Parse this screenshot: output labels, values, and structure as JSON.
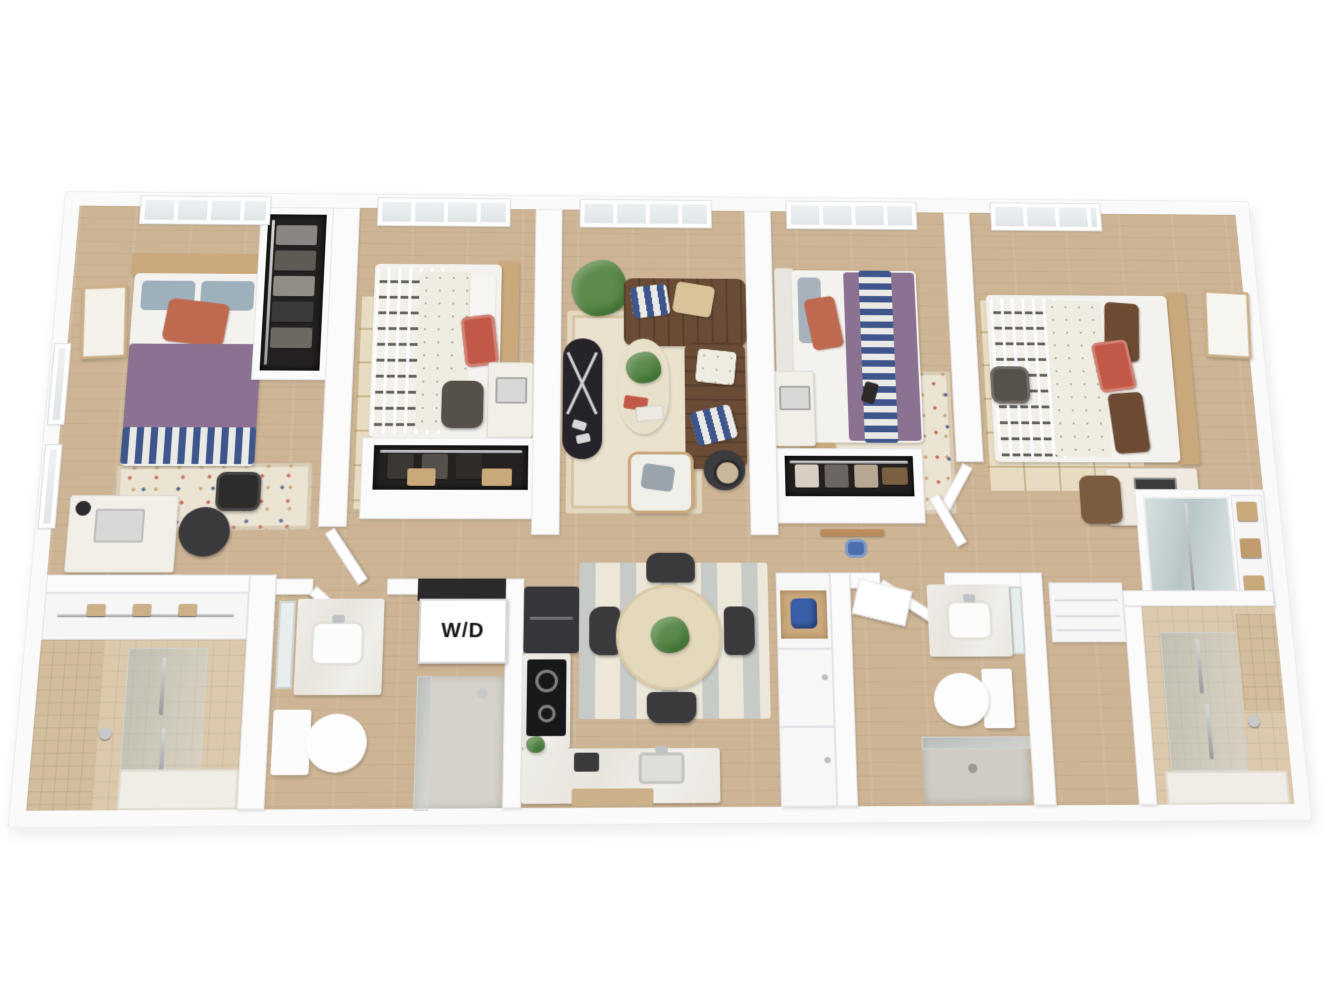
{
  "floorplan": {
    "type": "3d-apartment-floor-plan",
    "visible_text": {
      "washer_dryer": "W/D"
    },
    "rooms": [
      "bedroom-1",
      "bedroom-2",
      "living-room",
      "bedroom-3",
      "bedroom-4",
      "bathroom-1",
      "bathroom-2",
      "bathroom-3",
      "kitchen",
      "dining-area",
      "hallway",
      "walk-in-closets",
      "washer-dryer-closet"
    ],
    "colors": {
      "background": "#ffffff",
      "wall": "#fafafb",
      "wall_edge": "#e3e3e7",
      "wood_floor": "#ccb495",
      "tile_floor": "#dcc9ac",
      "rug_cream": "#eae2cf",
      "rug_tan": "#e7dcc2",
      "sofa_brown": "#6a4c36",
      "duvet_purple": "#8b7292",
      "navy_stripe": "#3f568c",
      "terracotta": "#bf6a50",
      "red_accent": "#c25847",
      "wood_furniture": "#c9a87c",
      "closet_dark": "#242120",
      "appliance_dark": "#2b2d31",
      "marble": "#ebe8e1",
      "mirror_glass": "#ccd6d8",
      "plant_green": "#5d8b4c",
      "mixer_blue": "#3a5fa8"
    }
  }
}
